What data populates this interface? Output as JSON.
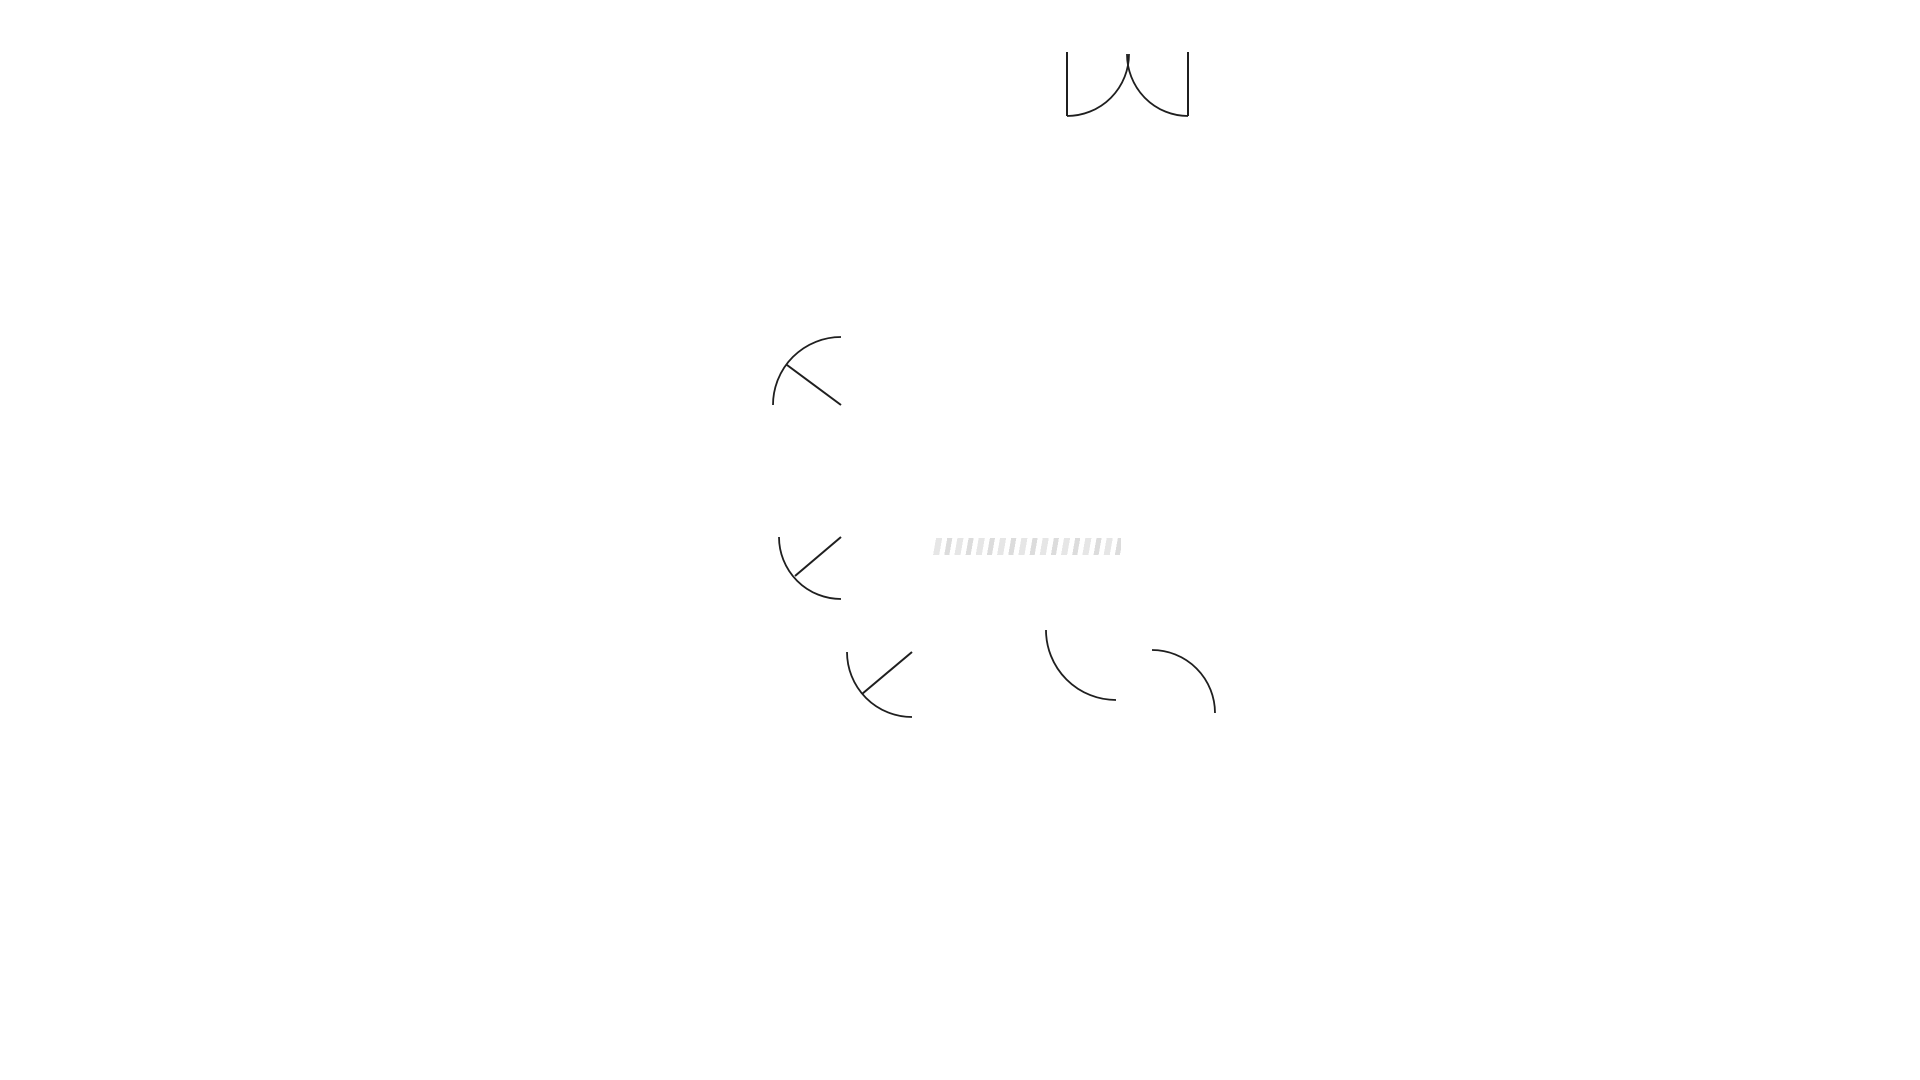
{
  "title": "FLOOR PLAN",
  "rooms": {
    "primary_bedroom": {
      "label": "PRIMARY BEDROOM",
      "dims": "2.82m x 5.75m"
    },
    "living_room": {
      "label": "LIVING ROOM",
      "dims": "3.26m x 3.53m"
    },
    "closet": {
      "label": "CLOSET"
    },
    "primary_bathroom": {
      "label_line1": "PRIMARY",
      "label_line2": "BATHROOM",
      "dims": "1.65m x 2.23m"
    },
    "dining_room": {
      "label": "DINING ROOM",
      "dims": "3.26m x 4.08m"
    },
    "hallway": {
      "label": "HALLWAY",
      "dims": "1.07m x 2.13m"
    },
    "bathroom": {
      "label": "BATHROOM",
      "dims": "1.65m x 1.55m"
    },
    "closet_small": {
      "label": "CLOSET"
    },
    "kitchen": {
      "label": "KITCHEN",
      "dims": "2.12m x 3.06m"
    },
    "entry": {
      "label": "ENTRY"
    },
    "bedroom": {
      "label": "BEDROOM",
      "dims": "2.72m x 3.50m"
    }
  },
  "colors": {
    "wall": "#000000",
    "label_text": "#1c1c1c",
    "title_text": "#2d2d2d",
    "fixture_line": "#222222",
    "logo_blue": "#1e3fa3"
  }
}
